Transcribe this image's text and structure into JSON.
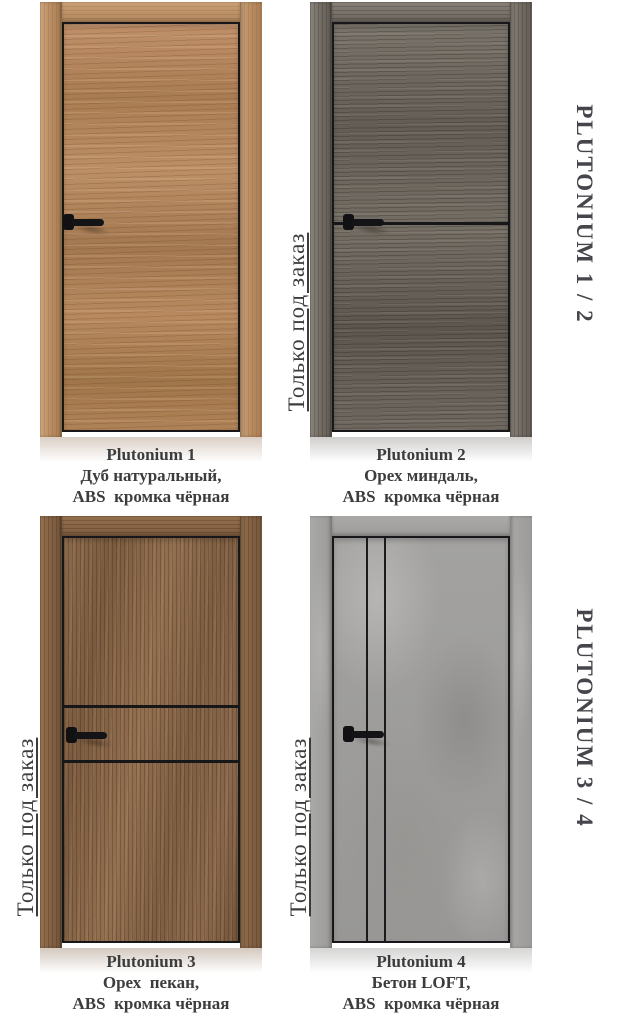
{
  "catalog": {
    "series_labels": [
      "PLUTONIUM 1 / 2",
      "PLUTONIUM 3 / 4"
    ],
    "order_note": "Только под заказ",
    "doors": [
      {
        "name": "Plutonium 1",
        "finish": "Дуб натуральный,",
        "edge": "ABS  кромка чёрная",
        "order_note_visible": false,
        "panel_color": "#b3855a",
        "accent_color": "#17171a"
      },
      {
        "name": "Plutonium 2",
        "finish": "Орех миндаль,",
        "edge": "ABS  кромка чёрная",
        "order_note_visible": true,
        "panel_color": "#6a645c",
        "accent_color": "#17171a"
      },
      {
        "name": "Plutonium 3",
        "finish": "Орех  пекан,",
        "edge": "ABS  кромка чёрная",
        "order_note_visible": true,
        "panel_color": "#876349",
        "accent_color": "#17171a"
      },
      {
        "name": "Plutonium 4",
        "finish": "Бетон LOFT,",
        "edge": "ABS  кромка чёрная",
        "order_note_visible": true,
        "panel_color": "#9b9a98",
        "accent_color": "#1b1b1e"
      }
    ],
    "text_color": "#3c3c3c",
    "series_label_color": "#45454b"
  }
}
